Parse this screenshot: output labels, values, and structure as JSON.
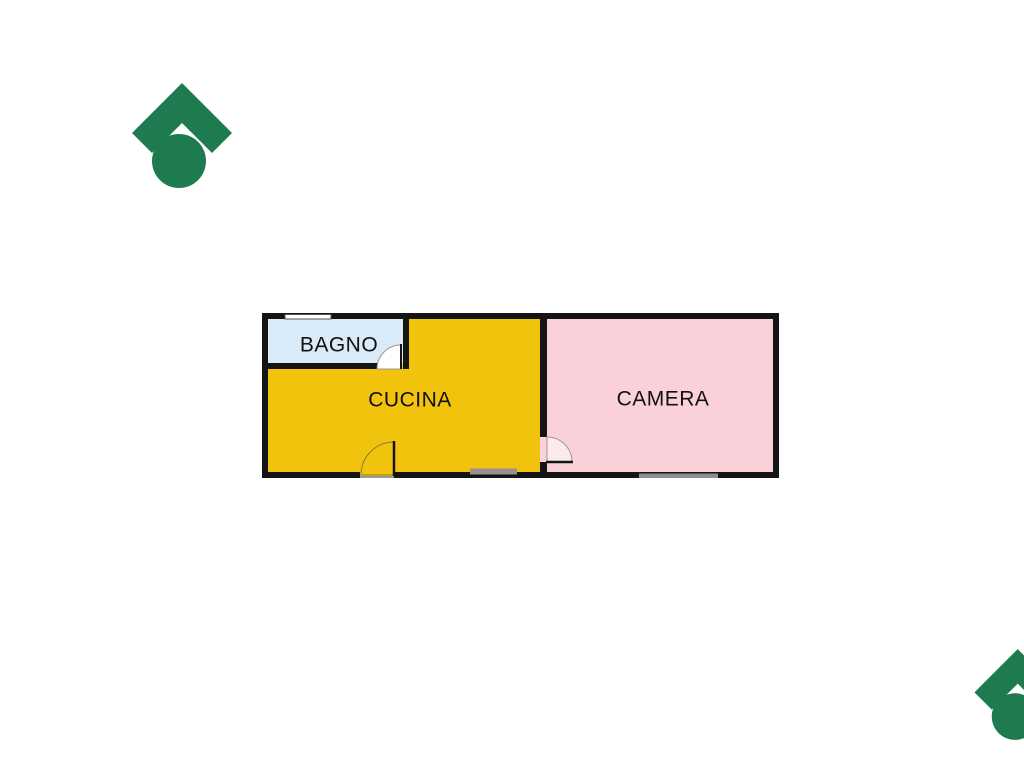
{
  "branding": {
    "logo_color": "#1E7B4F"
  },
  "floorplan": {
    "wall_color": "#141414",
    "label_color": "#111111",
    "rooms": [
      {
        "id": "bagno",
        "label": "BAGNO",
        "fill": "#D9EAF8"
      },
      {
        "id": "cucina",
        "label": "CUCINA",
        "fill": "#F2C30D"
      },
      {
        "id": "camera",
        "label": "CAMERA",
        "fill": "#FAD1D9"
      }
    ],
    "doors": {
      "bagno_door_fill": "#FFFFFF",
      "cucina_door_fill": "#F2C30D",
      "camera_door_fill": "#FBE9ED"
    },
    "windows": {
      "top_window_fill": "#FFFFFF",
      "cucina_window_fill": "#9C8F92",
      "camera_window_fill": "#8F8F8F",
      "threshold_fill": "#999999"
    }
  }
}
